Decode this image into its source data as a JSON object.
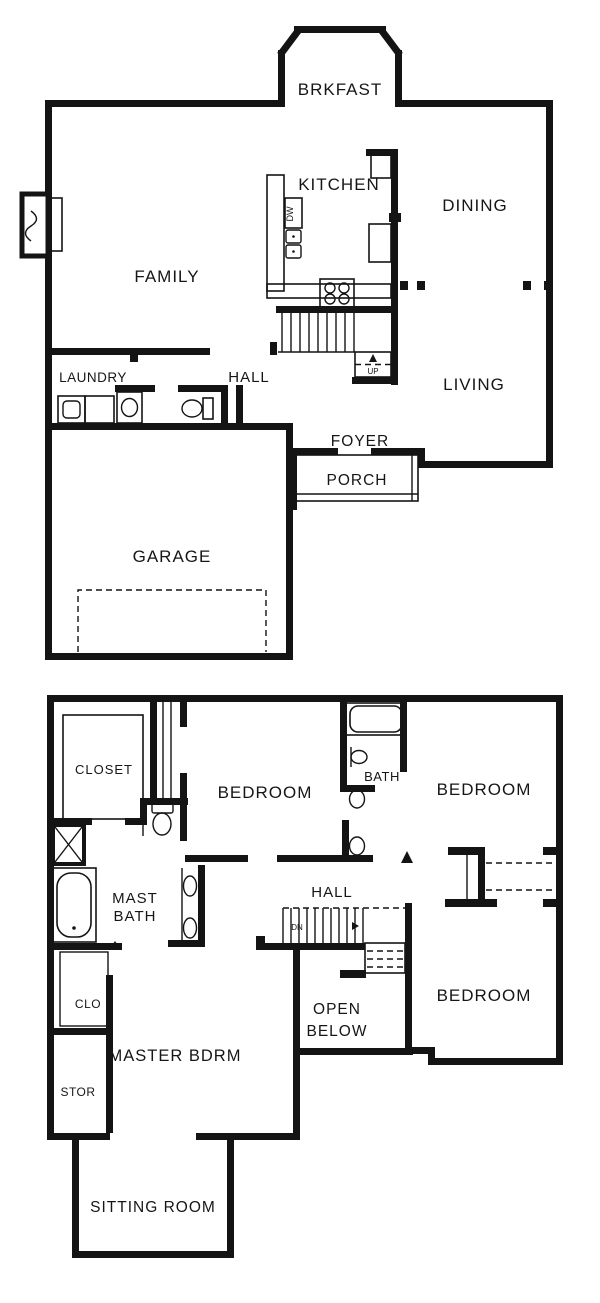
{
  "title": "Two-story house floor plan",
  "colors": {
    "wall": "#141414",
    "background": "#ffffff",
    "text": "#161616"
  },
  "floor1": {
    "rooms": {
      "brkfast": "BRKFAST",
      "kitchen": "KITCHEN",
      "dining": "DINING",
      "family": "FAMILY",
      "living": "LIVING",
      "laundry": "LAUNDRY",
      "hall": "HALL",
      "foyer": "FOYER",
      "porch": "PORCH",
      "garage": "GARAGE"
    },
    "annotations": {
      "up": "UP",
      "dishwasher": "DW"
    }
  },
  "floor2": {
    "rooms": {
      "closet": "CLOSET",
      "bedroom_top": "BEDROOM",
      "bath": "BATH",
      "bedroom_right": "BEDROOM",
      "mast_bath_line1": "MAST",
      "mast_bath_line2": "BATH",
      "hall": "HALL",
      "open_below_line1": "OPEN",
      "open_below_line2": "BELOW",
      "bedroom_bottom": "BEDROOM",
      "clo": "CLO",
      "master_bdrm": "MASTER BDRM",
      "stor": "STOR",
      "sitting_room": "SITTING ROOM"
    },
    "annotations": {
      "dn": "DN"
    }
  }
}
